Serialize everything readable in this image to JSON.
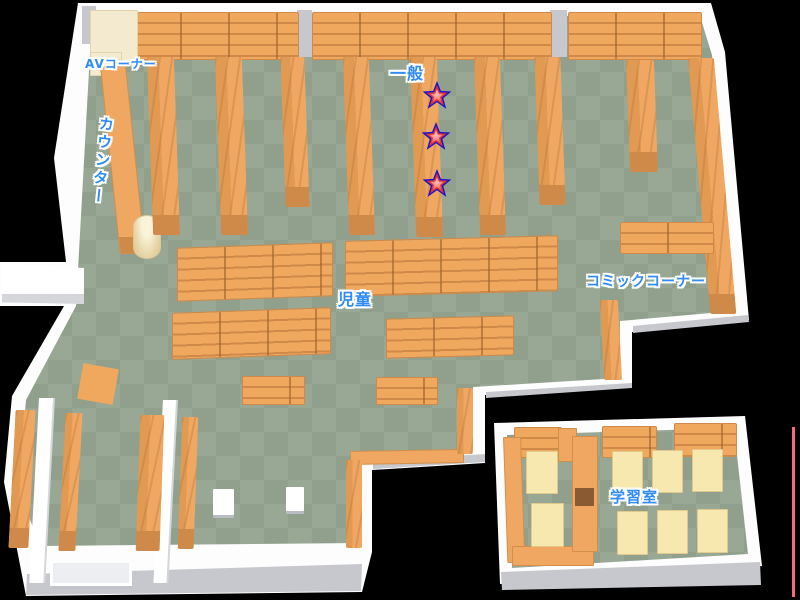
{
  "page": {
    "type": "library-floor-map",
    "background": "#000000"
  },
  "labels": {
    "av_corner": "AVコーナー",
    "counter": "カウンター",
    "general": "一般",
    "children": "児童",
    "comic_corner": "コミックコーナー",
    "study_room": "学習室"
  },
  "markers": {
    "stars": [
      {
        "id": "star-1",
        "area": "一般",
        "position": "top"
      },
      {
        "id": "star-2",
        "area": "一般",
        "position": "middle"
      },
      {
        "id": "star-3",
        "area": "一般",
        "position": "bottom"
      }
    ]
  },
  "colors": {
    "floor_checker_dark": "#90a08c",
    "floor_checker_light": "#99a795",
    "wall": "#ffffff",
    "wall_shade": "#c6c8ce",
    "shelf_orange": "#efa761",
    "shelf_line": "#cf8a49",
    "furniture_cream": "#f3ead0",
    "table_cream": "#f7e8b0",
    "label_blue": "#2e8bf7",
    "star_outline": "#1d14c9",
    "star_fill": "#e03535",
    "edge_line_red": "#f8697a"
  }
}
